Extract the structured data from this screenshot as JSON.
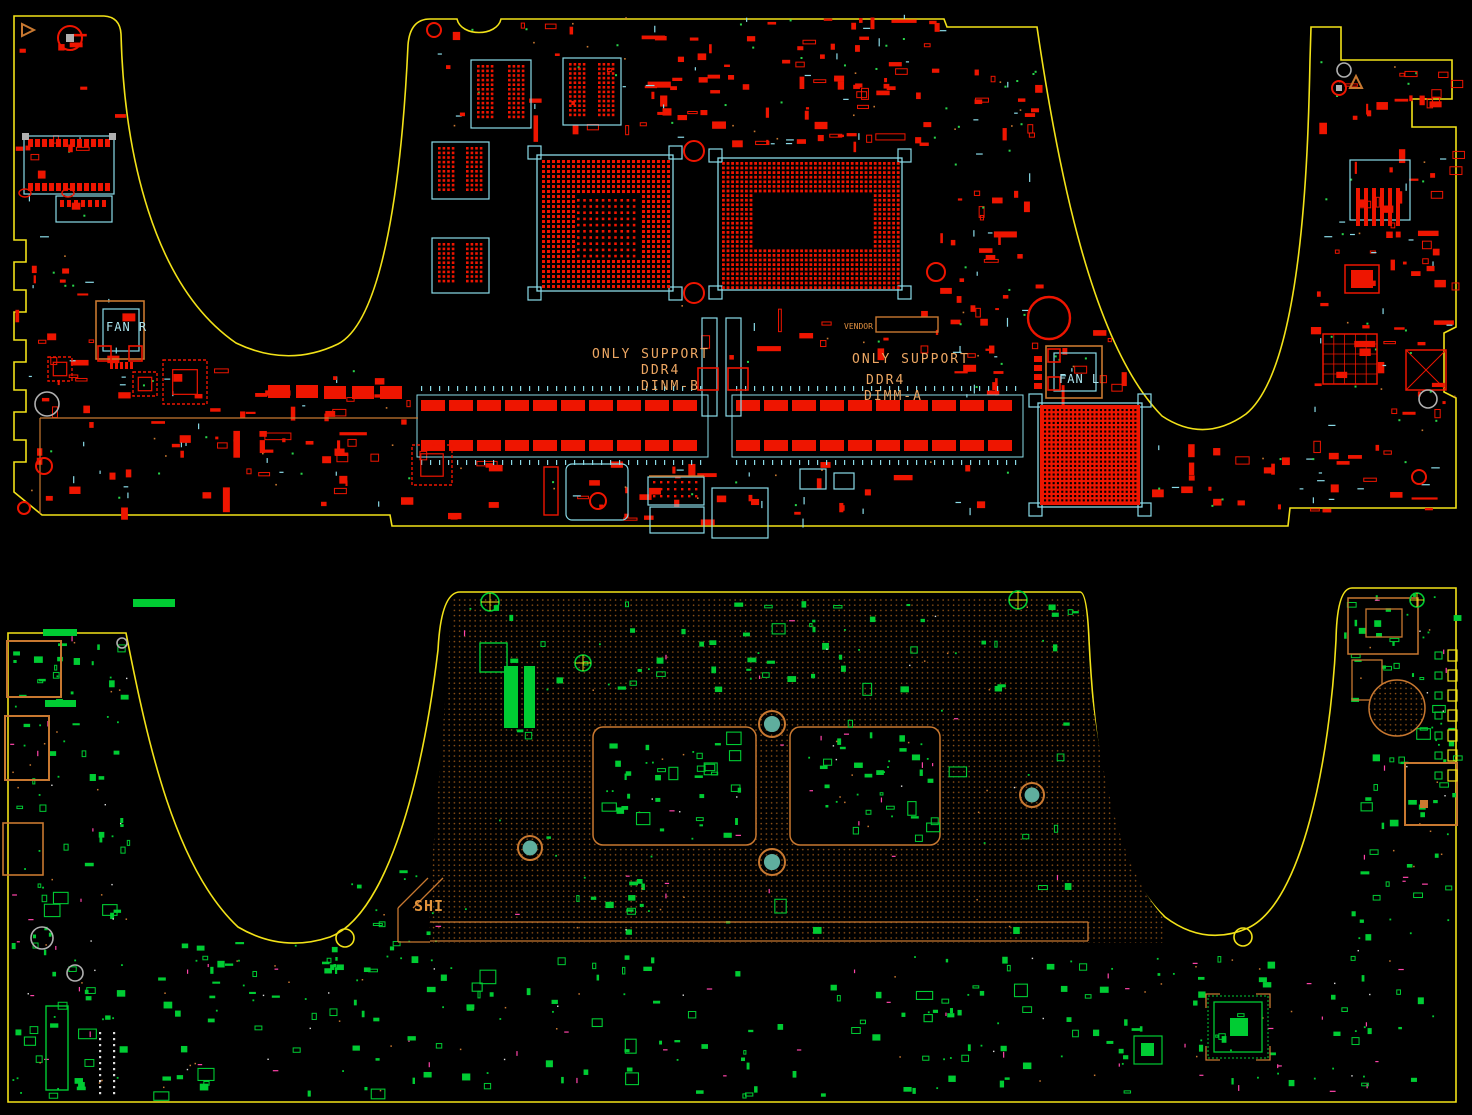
{
  "view": {
    "background": "#000000",
    "description": "PCB boardview - top and bottom sides of laptop motherboard"
  },
  "palette": {
    "board_outline": "#f2e218",
    "top_layer": "#ee1500",
    "courtyard": "#8adbe8",
    "silkscreen": "#c87830",
    "text_orange": "#eda763",
    "bottom_layer": "#00cc33",
    "via": "#ff44aa",
    "drill_gray": "#b0b0b0",
    "hole_teal": "#5fae9e"
  },
  "top_board": {
    "name": "top-side",
    "labels": {
      "dimm_b": {
        "line1": "ONLY SUPPORT",
        "line2": "DDR4",
        "line3": "DINM-B"
      },
      "dimm_a": {
        "line1": "ONLY SUPPORT",
        "line2": "DDR4",
        "line3": "DIMM-A"
      },
      "fan_right": "FAN R",
      "fan_left": "FAN L",
      "vendor": "VENDOR"
    }
  },
  "bottom_board": {
    "name": "bottom-side",
    "labels": {
      "heatpipe": "SHI"
    }
  }
}
